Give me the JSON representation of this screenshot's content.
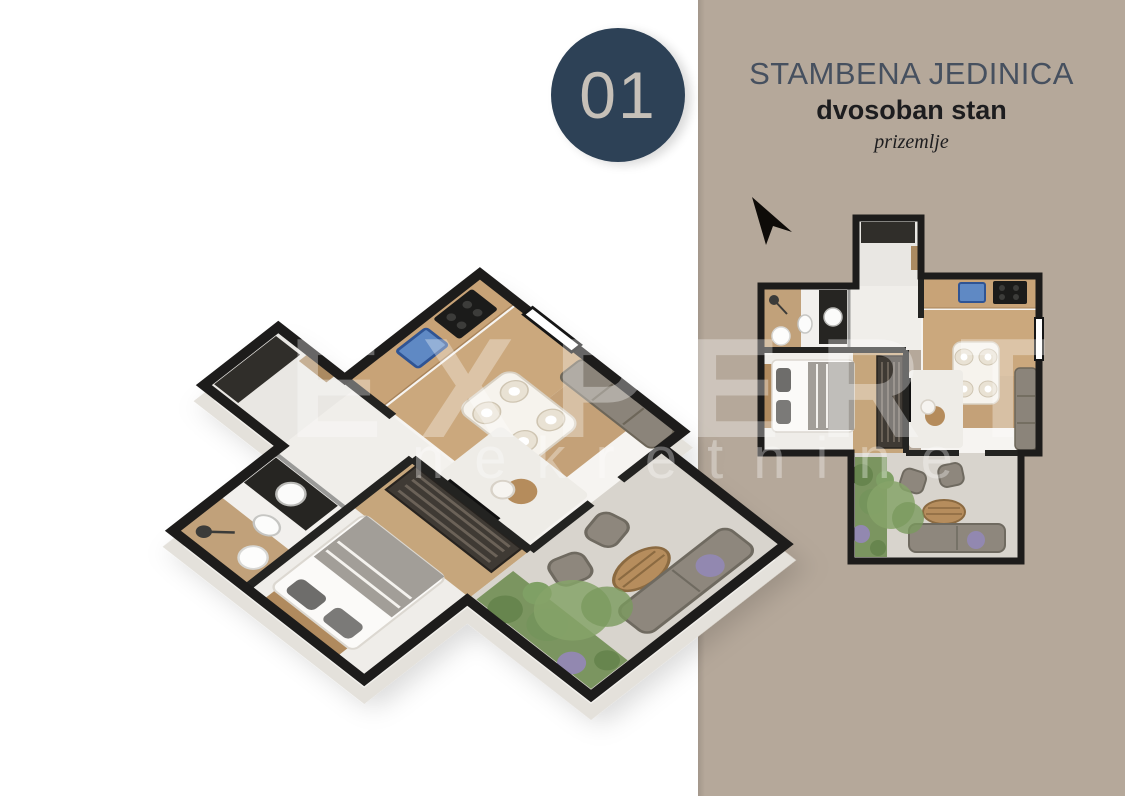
{
  "badge": {
    "number": "01"
  },
  "panel": {
    "title": "STAMBENA JEDINICA",
    "subtitle": "dvosoban stan",
    "floor": "prizemlje"
  },
  "watermark": {
    "line1": "EXPERT",
    "line2": "nekretnine"
  },
  "logo": {
    "name": "4zida",
    "tld": ".rs"
  },
  "colors": {
    "panel_bg": "#b5a89a",
    "badge_bg": "#2d4156",
    "badge_text": "#c6c0b8",
    "title_color": "#46505f",
    "body_text": "#1d1d1f",
    "wall_black": "#1d1c1b",
    "wood_floor": "#c8a377",
    "grass_green": "#7b9560",
    "logo_color": "#d2cabd"
  }
}
